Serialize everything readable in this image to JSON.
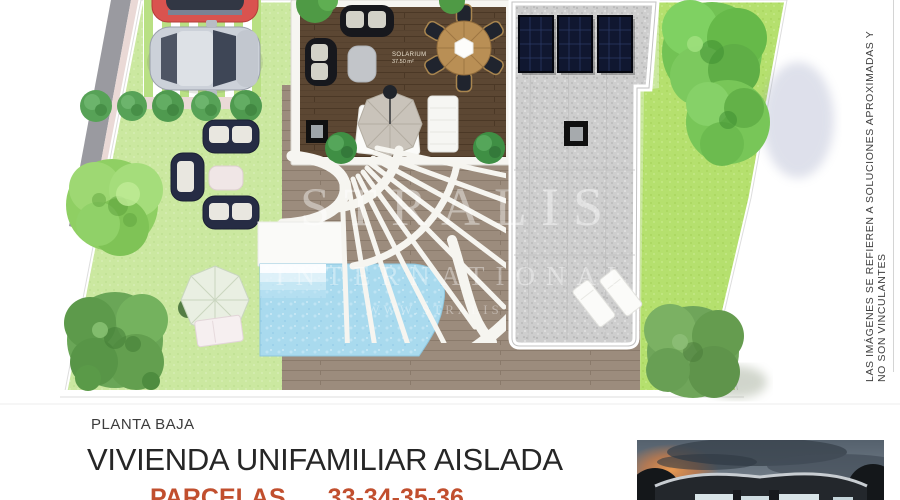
{
  "plan": {
    "solarium": {
      "label": "SOLARIUM",
      "area": "37.50 m²"
    },
    "watermark": {
      "brand": "STRALIS",
      "subtitle": "INTERNATIONAL",
      "url": "WWW.STRALIS"
    },
    "features": [
      "red-car",
      "silver-car",
      "parking-pavers",
      "street",
      "sidewalk",
      "hedge-row",
      "garden-sofa-set",
      "garden-trees",
      "parasol-daybed",
      "roof-deck-solarium",
      "outdoor-dining-table",
      "deck-parasol-loungers",
      "skylights",
      "gravel-roof",
      "solar-panels",
      "curved-pergola",
      "swimming-pool",
      "pool-steps",
      "pool-loungers",
      "wood-pool-deck",
      "parcel-fence"
    ]
  },
  "disclaimer": "LAS IMÁGENES SE REFIEREN A SOLUCIONES APROXIMADAS Y NO SON VINCULANTES",
  "footer": {
    "floor_label": "PLANTA BAJA",
    "title": "VIVIENDA UNIFAMILIAR AISLADA",
    "parcels_label": "PARCELAS",
    "parcels_numbers": "33-34-35-36"
  },
  "colors": {
    "accent_red": "#c14f2e",
    "lawn_light": "#cbe8a0",
    "lawn_bright": "#b5e06e",
    "deck_dark_wood": "#5c4733",
    "deck_taupe": "#9c8c7d",
    "gravel": "#cecece",
    "pool": "#a9daee",
    "solar_panel": "#101730",
    "sofa_navy": "#262c44",
    "street_gray": "#9a9aa0",
    "sidewalk_pink": "#ead9d6",
    "text_dark": "#262626"
  }
}
